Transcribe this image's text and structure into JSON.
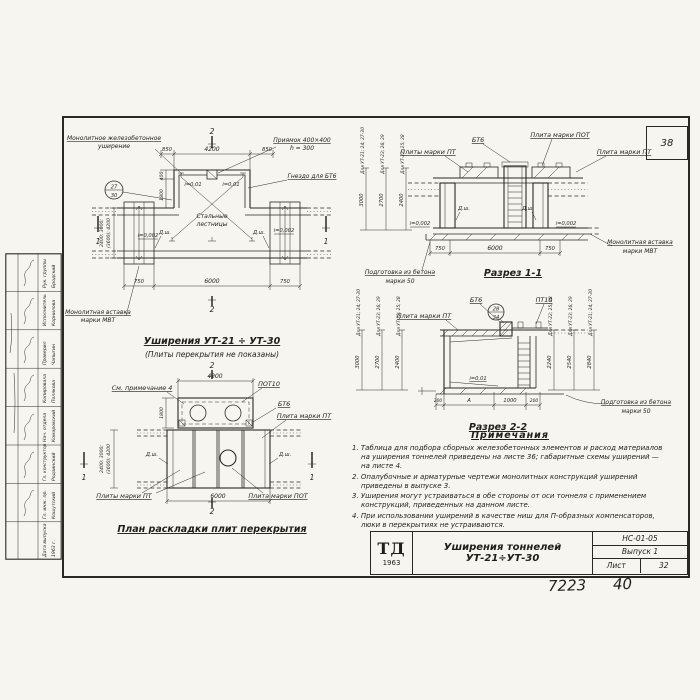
{
  "page": {
    "corner_number": "38",
    "footer_left": "7223",
    "footer_right": "40"
  },
  "stamp": {
    "entries": [
      {
        "role": "Рук. группы",
        "name": "Бродский"
      },
      {
        "role": "Исполнитель",
        "name": "Корнилова"
      },
      {
        "role": "Проверил",
        "name": "Чапыгин"
      },
      {
        "role": "Копировала",
        "name": "Полякова"
      },
      {
        "role": "Нач. отдела",
        "name": "Комаровский"
      },
      {
        "role": "Гл. конструктор",
        "name": "Родзинский"
      },
      {
        "role": "Гл. инж. пр.",
        "name": "Кошутский"
      },
      {
        "role": "Дата выпуска",
        "name": "1963 г."
      }
    ]
  },
  "plan_top": {
    "title": "Уширения  УТ-21 ÷ УТ-30",
    "subtitle": "(Плиты перекрытия не показаны)",
    "lbl_monolith1": "Монолитное железобетонное",
    "lbl_monolith2": "уширение",
    "lbl_pit1": "Приямок 400×400",
    "lbl_pit2": "h = 300",
    "lbl_socket": "Гнездо для БТ6",
    "lbl_ladder1": "Стальные",
    "lbl_ladder2": "лестницы",
    "lbl_insert1": "Монолитная вставка",
    "lbl_insert2": "марки МВТ",
    "detail_top": "27",
    "detail_bottom": "30",
    "slope_left_top": "i=0,01",
    "slope_right_top": "i=0,01",
    "slope_left": "i=0,002",
    "slope_right": "i=0,002",
    "dsh_left": "Д.ш.",
    "dsh_right": "Д.ш.",
    "dim_top": [
      "850",
      "4200",
      "850"
    ],
    "dim_bottom": [
      "750",
      "6000",
      "750"
    ],
    "dim_left": [
      "400",
      "1800"
    ],
    "dim_width1": "2400; 3000;",
    "dim_width2": "(3600); 4200",
    "sec_mark_1": "1",
    "sec_mark_2": "2"
  },
  "section11": {
    "title": "Разрез 1-1",
    "lbl_bt6": "БТ6",
    "lbl_pot": "Плита марки ПОТ",
    "lbl_pt_left": "Плиты марки ПТ",
    "lbl_pt_right": "Плита марки ПТ",
    "lbl_prep1": "Подготовка из бетона",
    "lbl_prep2": "марки 50",
    "lbl_insert1": "Монолитная вставка",
    "lbl_insert2": "марки МВТ",
    "slope_left": "i=0,002",
    "slope_right": "i=0,002",
    "dsh_left": "Д.ш.",
    "dsh_right": "Д.ш.",
    "dim_bottom": [
      "750",
      "6000",
      "750"
    ],
    "cols": [
      {
        "label": "Для УТ-21; 24; 27-30",
        "value": "3000"
      },
      {
        "label": "Для УТ-23; 26; 29",
        "value": "2700"
      },
      {
        "label": "Для УТ-22; 25; 28",
        "value": "2400"
      }
    ]
  },
  "section22": {
    "title": "Разрез 2-2",
    "lbl_pt": "Плита марки ПТ",
    "lbl_bt6": "БТ6",
    "lbl_pt10": "ПТ10",
    "detail_top": "28",
    "detail_bottom": "34",
    "slope": "i=0,01",
    "lbl_prep1": "Подготовка из бетона",
    "lbl_prep2": "марки 50",
    "dim_bottom": [
      "200",
      "А",
      "1000",
      "200"
    ],
    "left_cols": [
      {
        "label": "Для УТ-21; 24; 27-30",
        "value": "3000"
      },
      {
        "label": "Для УТ-23; 26; 29",
        "value": "2700"
      },
      {
        "label": "Для УТ-22; 25; 28",
        "value": "2400"
      }
    ],
    "right_cols": [
      {
        "label": "Для УТ-22; 25; 28",
        "value": "2240"
      },
      {
        "label": "Для УТ-23; 26; 29",
        "value": "2540"
      },
      {
        "label": "Для УТ-21; 24; 27-30",
        "value": "2840"
      }
    ]
  },
  "plan_bottom": {
    "title": "План раскладки плит перекрытия",
    "lbl_note": "См. примечание 4",
    "lbl_pot10": "ПОТ10",
    "lbl_bt6": "БТ6",
    "lbl_pt_right": "Плита марки ПТ",
    "lbl_pt_left": "Плиты марки ПТ",
    "lbl_pot": "Плита марки ПОТ",
    "dsh_left": "Д.ш.",
    "dsh_right": "Д.ш.",
    "dim_top": "4200",
    "dim_bottom": "6000",
    "dim_left": "1800",
    "dim_width1": "2400; 3000;",
    "dim_width2": "(3600); 4200",
    "sec_mark_1": "1",
    "sec_mark_2": "2"
  },
  "notes": {
    "title": "Примечания",
    "items": [
      "1. Таблица для подбора сборных железобетонных элементов и расход материалов на уширения тоннелей приведены на листе 36; габаритные схемы уширений — на листе 4.",
      "2. Опалубочные и арматурные чертежи монолитных конструкций уширений приведены в выпуске 3.",
      "3. Уширения могут устраиваться в обе стороны от оси тоннеля с применением конструкций, приведенных на данном листе.",
      "4. При использовании уширений в качестве ниш для П-образных компенсаторов, люки в перекрытиях не устраиваются."
    ]
  },
  "titleblock": {
    "logo_top": "ТД",
    "logo_year": "1963",
    "title": "Уширения тоннелей УТ-21÷УТ-30",
    "code": "НС-01-05",
    "issue": "Выпуск 1",
    "sheet_label": "Лист",
    "sheet_number": "32"
  }
}
